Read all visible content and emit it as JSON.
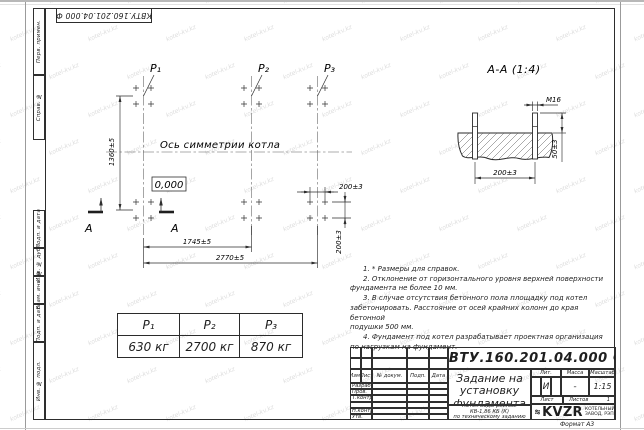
{
  "colors": {
    "line": "#2e2e2e",
    "paper": "#ffffff",
    "watermark": "#c7c7c7"
  },
  "stamp": {
    "doc_number": "КВТУ.160.201.04.000 Ф"
  },
  "margin_labels": [
    "Перв. примен.",
    "Справ. №",
    "Подп. и дата",
    "Инв. № дубл.",
    "Взам. инв. №",
    "Подп. и дата",
    "Инв. № подл."
  ],
  "plan": {
    "p_labels": [
      "P₁",
      "P₂",
      "P₃"
    ],
    "axis_label": "Ось симметрии котла",
    "elevation": "0,000",
    "dim_height": "1360±5",
    "dim_width_inner": "1745±5",
    "dim_width_outer": "2770±5",
    "dim_bolt_x": "200±3",
    "dim_bolt_y": "200±3",
    "section_letter": "А"
  },
  "section": {
    "title": "А-А (1:4)",
    "bolt_thread": "М16",
    "dim_height": "50±3",
    "dim_spacing": "200±3"
  },
  "notes": {
    "lines": [
      "1. * Размеры для справок.",
      "2. Отклонение от горизонтального уровня верхней поверхности",
      "фундамента не более 10 мм.",
      "3. В случае отсутствия бетонного пола площадку под котел",
      "забетонировать. Расстояние от осей крайних колонн до края бетонной",
      "подушки 500 мм.",
      "4. Фундамент под котел разрабатывает проектная организация",
      "по нагрузкам на фундамент."
    ]
  },
  "load_table": {
    "headers": [
      "P₁",
      "P₂",
      "P₃"
    ],
    "values": [
      "630 кг",
      "2700 кг",
      "870 кг"
    ]
  },
  "title_block": {
    "doc_number": "КВТУ.160.201.04.000 Ф",
    "title_lines": [
      "Задание на",
      "установку",
      "фундамента"
    ],
    "product_lines": [
      "Котел водогрейный",
      "КВ-1,86 КБ (К)",
      "по техническому заданию"
    ],
    "col_headers": [
      "Изм.",
      "Лист",
      "№ докум.",
      "Подп.",
      "Дата"
    ],
    "row_labels": [
      "Разраб.",
      "Пров.",
      "Т.контр.",
      "Н.контр.",
      "Утв."
    ],
    "lit_header": "Лит.",
    "mass_header": "Масса",
    "scale_header": "Масштаб",
    "lit_value": "И",
    "mass_value": "-",
    "scale_value": "1:15",
    "sheet_label": "Лист",
    "sheets_label": "Листов",
    "sheets_value": "1",
    "logo_text": "KVZR",
    "company_lines": [
      "КОТЕЛЬНЫЙ",
      "ЗАВОД, РЭП"
    ],
    "format_label": "Формат А3"
  },
  "watermark": {
    "text": "kotel-kv.kz"
  }
}
